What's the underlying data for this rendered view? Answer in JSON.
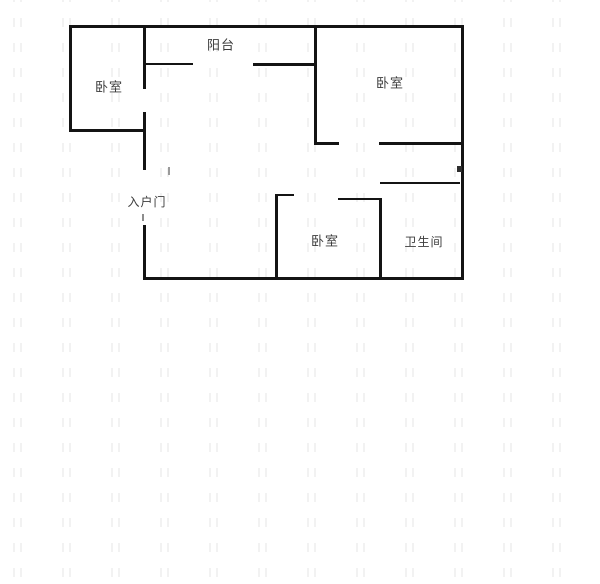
{
  "meta": {
    "type": "apartment-floorplan",
    "background": "#ffffff",
    "wall_color": "#141414",
    "label_color": "#3c3c3c"
  },
  "floorplan": {
    "width": 600,
    "height": 584,
    "labels": [
      {
        "id": "balcony",
        "text": "阳台",
        "x": 221,
        "y": 46,
        "size": 13
      },
      {
        "id": "bedroom-top-left",
        "text": "卧室",
        "x": 109,
        "y": 88,
        "size": 13
      },
      {
        "id": "bedroom-top-right",
        "text": "卧室",
        "x": 390,
        "y": 84,
        "size": 13
      },
      {
        "id": "entrance-door",
        "text": "入户门",
        "x": 147,
        "y": 202,
        "size": 12
      },
      {
        "id": "bedroom-bottom",
        "text": "卧室",
        "x": 325,
        "y": 242,
        "size": 13
      },
      {
        "id": "bathroom",
        "text": "卫生间",
        "x": 424,
        "y": 242,
        "size": 12
      }
    ],
    "walls": [
      {
        "n": "outer-top-wall",
        "x": 69,
        "y": 25,
        "w": 395,
        "h": 3
      },
      {
        "n": "outer-left-wall-upper",
        "x": 69,
        "y": 25,
        "w": 3,
        "h": 107
      },
      {
        "n": "outer-right-wall",
        "x": 461,
        "y": 25,
        "w": 3,
        "h": 255
      },
      {
        "n": "outer-bottom-wall",
        "x": 143,
        "y": 277,
        "w": 321,
        "h": 3
      },
      {
        "n": "bedroom-top-left-bottom-wall",
        "x": 69,
        "y": 129,
        "w": 77,
        "h": 3
      },
      {
        "n": "entry-wall-upper",
        "x": 143,
        "y": 25,
        "w": 3,
        "h": 64
      },
      {
        "n": "entry-wall-middle",
        "x": 143,
        "y": 112,
        "w": 3,
        "h": 58
      },
      {
        "n": "entry-wall-lower",
        "x": 143,
        "y": 225,
        "w": 3,
        "h": 55
      },
      {
        "n": "balcony-rail-left",
        "x": 144,
        "y": 63,
        "w": 49,
        "h": 2
      },
      {
        "n": "balcony-rail-right",
        "x": 253,
        "y": 63,
        "w": 63,
        "h": 3
      },
      {
        "n": "bedroom-top-right-left-wall",
        "x": 314,
        "y": 25,
        "w": 3,
        "h": 120
      },
      {
        "n": "bedroom-top-right-bottom-wall-left",
        "x": 314,
        "y": 142,
        "w": 25,
        "h": 3
      },
      {
        "n": "bedroom-top-right-bottom-wall-right",
        "x": 379,
        "y": 142,
        "w": 83,
        "h": 3
      },
      {
        "n": "bathroom-top-wall",
        "x": 380,
        "y": 182,
        "w": 80,
        "h": 2
      },
      {
        "n": "bedroom-bottom-top-stub",
        "x": 275,
        "y": 194,
        "w": 19,
        "h": 2
      },
      {
        "n": "bedroom-bottom-left-wall",
        "x": 275,
        "y": 194,
        "w": 3,
        "h": 86
      },
      {
        "n": "bedroom-bottom-top-wall",
        "x": 338,
        "y": 198,
        "w": 44,
        "h": 2
      },
      {
        "n": "bedroom-bottom-right-wall",
        "x": 379,
        "y": 198,
        "w": 3,
        "h": 82
      },
      {
        "n": "entry-door-tick",
        "x": 142,
        "y": 214,
        "w": 2,
        "h": 7,
        "c": "#8d8d8d"
      },
      {
        "n": "hall-door-tick",
        "x": 168,
        "y": 167,
        "w": 2,
        "h": 8,
        "c": "#9a9a9a"
      },
      {
        "n": "right-wall-door-nub",
        "x": 457,
        "y": 166,
        "w": 5,
        "h": 6,
        "c": "#2e2e2e"
      }
    ]
  }
}
